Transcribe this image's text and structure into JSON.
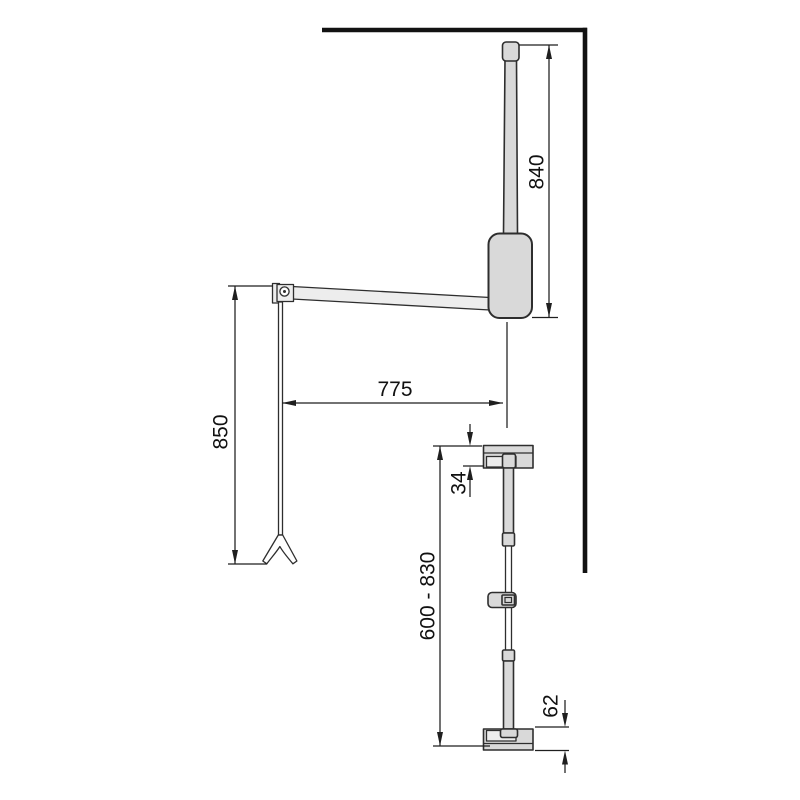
{
  "meta": {
    "description": "Technical dimension drawing of a pull-down wardrobe lift (side view with wall corner) and its adjustable vertical post (front view)",
    "units": "mm"
  },
  "colors": {
    "bg": "#ffffff",
    "outline": "#2e2e2e",
    "fill": "#d9d9d9",
    "fill_light": "#ededed",
    "wall": "#121212",
    "dim": "#1f1f1f",
    "text": "#111111"
  },
  "dimensions": {
    "hanger_rod_height": "840",
    "arm_reach": "775",
    "pull_rod_length": "850",
    "top_bracket_height": "34",
    "post_adjustable_range": "600 - 830",
    "bottom_bracket_height": "62"
  }
}
